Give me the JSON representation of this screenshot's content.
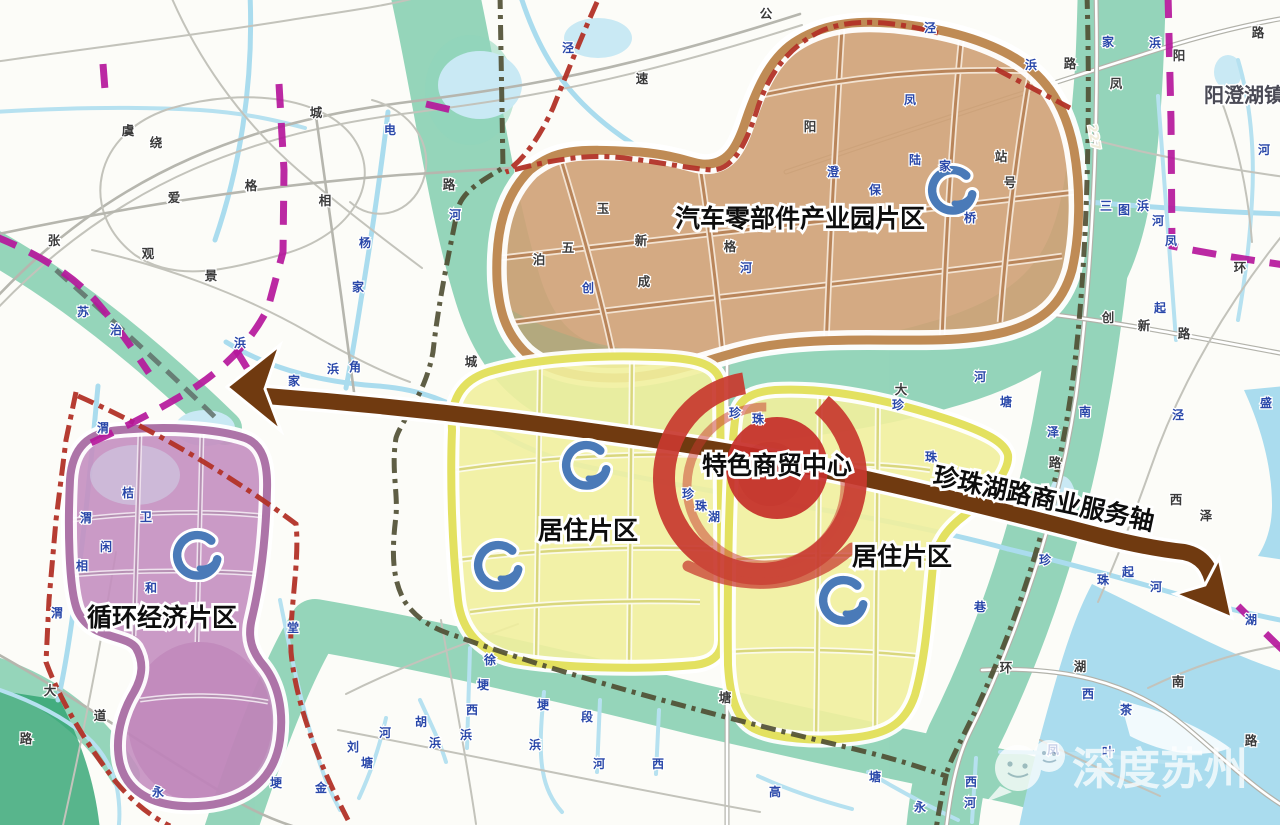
{
  "town": {
    "label": "阳澄湖镇"
  },
  "watermark": {
    "text": "深度苏州"
  },
  "axis": {
    "label": "珍珠湖路商业服务轴",
    "color": "#703a10"
  },
  "regions": [
    {
      "name": "auto-parts-industrial-park",
      "label": "汽车零部件产业园片区",
      "fill": "#cfa176",
      "ring": "#bf8b55"
    },
    {
      "name": "residential-west",
      "label": "居住片区",
      "fill": "#f1ef9d",
      "ring": "#e3e160"
    },
    {
      "name": "residential-east",
      "label": "居住片区",
      "fill": "#f1ef9d",
      "ring": "#e3e160"
    },
    {
      "name": "circular-economy",
      "label": "循环经济片区",
      "fill": "#c48fc0",
      "ring": "#ad74a8"
    },
    {
      "name": "commerce-center",
      "label": "特色商贸中心",
      "fill": "#c62f2a"
    }
  ],
  "colors": {
    "green_corridor": "#56bd95",
    "axis_brown": "#703a10",
    "commerce_red": "#c8392f",
    "boundary_magenta": "#b5179b",
    "boundary_red": "#b23227",
    "boundary_olive": "#4e4c31",
    "river_blue": "#aadcee",
    "node_icon_blue": "#4a7ab8"
  },
  "c_icons": [
    {
      "x": 952,
      "y": 190
    },
    {
      "x": 586,
      "y": 465
    },
    {
      "x": 498,
      "y": 565
    },
    {
      "x": 843,
      "y": 600
    },
    {
      "x": 197,
      "y": 555
    }
  ],
  "road_labels": [
    {
      "t": "虞",
      "x": 128,
      "y": 135
    },
    {
      "t": "绕",
      "x": 156,
      "y": 147
    },
    {
      "t": "城",
      "x": 316,
      "y": 117
    },
    {
      "t": "公",
      "x": 766,
      "y": 18
    },
    {
      "t": "速",
      "x": 642,
      "y": 83
    },
    {
      "t": "爱",
      "x": 174,
      "y": 202
    },
    {
      "t": "格",
      "x": 251,
      "y": 190
    },
    {
      "t": "相",
      "x": 325,
      "y": 205
    },
    {
      "t": "张",
      "x": 54,
      "y": 245
    },
    {
      "t": "观",
      "x": 148,
      "y": 258
    },
    {
      "t": "景",
      "x": 211,
      "y": 280
    },
    {
      "t": "阳",
      "x": 1179,
      "y": 60
    },
    {
      "t": "凤",
      "x": 1116,
      "y": 88
    },
    {
      "t": "路",
      "x": 1258,
      "y": 37
    },
    {
      "t": "路",
      "x": 1070,
      "y": 68
    },
    {
      "t": "大",
      "x": 50,
      "y": 695
    },
    {
      "t": "道",
      "x": 100,
      "y": 720
    },
    {
      "t": "路",
      "x": 26,
      "y": 743
    },
    {
      "t": "创",
      "x": 1108,
      "y": 322
    },
    {
      "t": "新",
      "x": 1144,
      "y": 330
    },
    {
      "t": "路",
      "x": 1184,
      "y": 338
    },
    {
      "t": "环",
      "x": 1240,
      "y": 272
    },
    {
      "t": "环",
      "x": 1006,
      "y": 672
    },
    {
      "t": "湖",
      "x": 1080,
      "y": 671
    },
    {
      "t": "南",
      "x": 1178,
      "y": 686
    },
    {
      "t": "路",
      "x": 1251,
      "y": 745
    },
    {
      "t": "泽",
      "x": 1206,
      "y": 520
    },
    {
      "t": "西",
      "x": 1176,
      "y": 504
    },
    {
      "t": "塘",
      "x": 725,
      "y": 702
    },
    {
      "t": "城",
      "x": 471,
      "y": 366
    },
    {
      "t": "路",
      "x": 449,
      "y": 189
    },
    {
      "t": "五",
      "x": 568,
      "y": 252
    },
    {
      "t": "泊",
      "x": 539,
      "y": 264
    },
    {
      "t": "成",
      "x": 644,
      "y": 286
    },
    {
      "t": "新",
      "x": 641,
      "y": 245
    },
    {
      "t": "玉",
      "x": 603,
      "y": 213
    },
    {
      "t": "格",
      "x": 730,
      "y": 251
    },
    {
      "t": "阳",
      "x": 810,
      "y": 131
    },
    {
      "t": "站",
      "x": 1001,
      "y": 161
    },
    {
      "t": "号",
      "x": 1010,
      "y": 187
    },
    {
      "t": "大",
      "x": 901,
      "y": 394
    },
    {
      "t": "路",
      "x": 1055,
      "y": 467
    },
    {
      "t": "227",
      "x": 1090,
      "y": 138,
      "r": 80,
      "s": 11,
      "c": "#f0ecda"
    }
  ],
  "river_labels": [
    {
      "t": "泾",
      "x": 930,
      "y": 32
    },
    {
      "t": "泾",
      "x": 568,
      "y": 52
    },
    {
      "t": "河",
      "x": 455,
      "y": 219
    },
    {
      "t": "浜",
      "x": 240,
      "y": 347
    },
    {
      "t": "家",
      "x": 294,
      "y": 385
    },
    {
      "t": "浜",
      "x": 333,
      "y": 373
    },
    {
      "t": "角",
      "x": 355,
      "y": 371
    },
    {
      "t": "电",
      "x": 390,
      "y": 134
    },
    {
      "t": "杨",
      "x": 365,
      "y": 247
    },
    {
      "t": "家",
      "x": 358,
      "y": 291
    },
    {
      "t": "苏",
      "x": 83,
      "y": 316
    },
    {
      "t": "治",
      "x": 116,
      "y": 334
    },
    {
      "t": "渭",
      "x": 103,
      "y": 432
    },
    {
      "t": "渭",
      "x": 86,
      "y": 522
    },
    {
      "t": "渭",
      "x": 57,
      "y": 617
    },
    {
      "t": "桔",
      "x": 128,
      "y": 497
    },
    {
      "t": "卫",
      "x": 146,
      "y": 521
    },
    {
      "t": "闲",
      "x": 106,
      "y": 551
    },
    {
      "t": "相",
      "x": 82,
      "y": 570
    },
    {
      "t": "和",
      "x": 151,
      "y": 592
    },
    {
      "t": "堂",
      "x": 293,
      "y": 632
    },
    {
      "t": "埂",
      "x": 276,
      "y": 787
    },
    {
      "t": "金",
      "x": 321,
      "y": 792
    },
    {
      "t": "永",
      "x": 158,
      "y": 796
    },
    {
      "t": "珍",
      "x": 735,
      "y": 417
    },
    {
      "t": "珠",
      "x": 758,
      "y": 423
    },
    {
      "t": "珍",
      "x": 688,
      "y": 498
    },
    {
      "t": "珠",
      "x": 701,
      "y": 510
    },
    {
      "t": "湖",
      "x": 714,
      "y": 521
    },
    {
      "t": "珍",
      "x": 898,
      "y": 409
    },
    {
      "t": "珠",
      "x": 931,
      "y": 461
    },
    {
      "t": "河",
      "x": 980,
      "y": 381
    },
    {
      "t": "塘",
      "x": 1006,
      "y": 406
    },
    {
      "t": "南",
      "x": 1085,
      "y": 416
    },
    {
      "t": "泽",
      "x": 1053,
      "y": 436
    },
    {
      "t": "珍",
      "x": 1045,
      "y": 564
    },
    {
      "t": "珠",
      "x": 1103,
      "y": 584
    },
    {
      "t": "起",
      "x": 1128,
      "y": 576
    },
    {
      "t": "河",
      "x": 1156,
      "y": 591
    },
    {
      "t": "三",
      "x": 1106,
      "y": 210
    },
    {
      "t": "图",
      "x": 1124,
      "y": 214
    },
    {
      "t": "浜",
      "x": 1143,
      "y": 210
    },
    {
      "t": "河",
      "x": 1158,
      "y": 225
    },
    {
      "t": "凤",
      "x": 1171,
      "y": 245
    },
    {
      "t": "起",
      "x": 1160,
      "y": 312
    },
    {
      "t": "河",
      "x": 1264,
      "y": 154
    },
    {
      "t": "浜",
      "x": 1031,
      "y": 69
    },
    {
      "t": "家",
      "x": 1108,
      "y": 46
    },
    {
      "t": "浜",
      "x": 1155,
      "y": 47
    },
    {
      "t": "桥",
      "x": 970,
      "y": 222
    },
    {
      "t": "凤",
      "x": 910,
      "y": 104
    },
    {
      "t": "澄",
      "x": 833,
      "y": 176
    },
    {
      "t": "陆",
      "x": 915,
      "y": 164
    },
    {
      "t": "家",
      "x": 945,
      "y": 170
    },
    {
      "t": "保",
      "x": 875,
      "y": 194
    },
    {
      "t": "河",
      "x": 746,
      "y": 272
    },
    {
      "t": "创",
      "x": 588,
      "y": 292
    },
    {
      "t": "湖",
      "x": 1251,
      "y": 624
    },
    {
      "t": "茶",
      "x": 1126,
      "y": 714
    },
    {
      "t": "西",
      "x": 1088,
      "y": 698
    },
    {
      "t": "盛",
      "x": 1266,
      "y": 407
    },
    {
      "t": "泾",
      "x": 1178,
      "y": 419
    },
    {
      "t": "巷",
      "x": 980,
      "y": 611
    },
    {
      "t": "凤",
      "x": 1053,
      "y": 754
    },
    {
      "t": "叶",
      "x": 1108,
      "y": 756
    },
    {
      "t": "徐",
      "x": 490,
      "y": 664
    },
    {
      "t": "埂",
      "x": 483,
      "y": 689
    },
    {
      "t": "西",
      "x": 472,
      "y": 714
    },
    {
      "t": "浜",
      "x": 466,
      "y": 739
    },
    {
      "t": "埂",
      "x": 543,
      "y": 709
    },
    {
      "t": "段",
      "x": 587,
      "y": 721
    },
    {
      "t": "浜",
      "x": 535,
      "y": 749
    },
    {
      "t": "河",
      "x": 599,
      "y": 768
    },
    {
      "t": "西",
      "x": 658,
      "y": 768
    },
    {
      "t": "胡",
      "x": 421,
      "y": 726
    },
    {
      "t": "浜",
      "x": 435,
      "y": 747
    },
    {
      "t": "河",
      "x": 385,
      "y": 737
    },
    {
      "t": "刘",
      "x": 353,
      "y": 751
    },
    {
      "t": "塘",
      "x": 367,
      "y": 767
    },
    {
      "t": "高",
      "x": 775,
      "y": 796
    },
    {
      "t": "塘",
      "x": 875,
      "y": 781
    },
    {
      "t": "永",
      "x": 920,
      "y": 811
    },
    {
      "t": "西",
      "x": 971,
      "y": 786
    },
    {
      "t": "河",
      "x": 970,
      "y": 807
    }
  ]
}
